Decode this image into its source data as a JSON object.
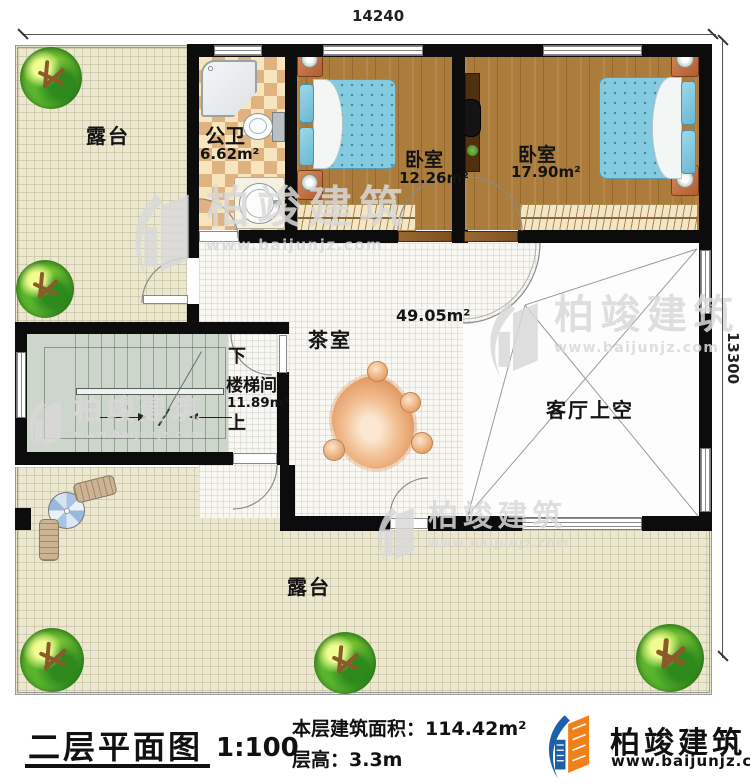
{
  "plan": {
    "dim_width": "14240",
    "dim_height": "13300",
    "terrace_top_label": "露台",
    "bathroom_label": "公卫",
    "bathroom_area": "6.62m²",
    "bedroom1_label": "卧室",
    "bedroom1_area": "12.26m²",
    "bedroom2_label": "卧室",
    "bedroom2_area": "17.90m²",
    "tearoom_label": "茶室",
    "tearoom_area": "49.05m²",
    "stairwell_label": "楼梯间",
    "stairwell_area": "11.89m²",
    "stairs_down": "下",
    "stairs_up": "上",
    "living_void_label": "客厅上空",
    "terrace_bottom_label": "露台"
  },
  "watermark": {
    "brand": "柏竣建筑",
    "url": "www.baijunjz.com"
  },
  "footer": {
    "title": "二层平面图",
    "scale": "1:100",
    "area_line": "本层建筑面积：114.42m²",
    "height_line": "层高：3.3m",
    "brand": "柏竣建筑",
    "url": "www.baijunjz.com"
  },
  "colors": {
    "wall": "#0c0c0c",
    "wood": "#ab7c3c",
    "brand_blue": "#1e5fa8",
    "brand_orange": "#f08018"
  }
}
